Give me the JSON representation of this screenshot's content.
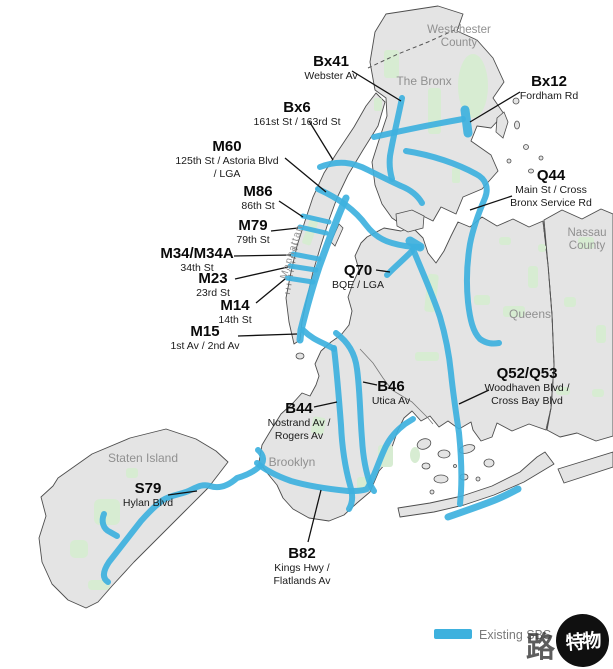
{
  "colors": {
    "route_blue": "#3EB1DE",
    "land_gray": "#e4e4e4",
    "park_green": "#d7ecd2",
    "region_label_gray": "#909090"
  },
  "regions": {
    "westchester_line1": "Westchester",
    "westchester_line2": "County",
    "bronx": "The Bronx",
    "nassau_line1": "Nassau",
    "nassau_line2": "County",
    "queens": "Queens",
    "brooklyn": "Brooklyn",
    "staten_island": "Staten Island",
    "manhattan": "Manhattan"
  },
  "routes": [
    {
      "name": "Bx41",
      "sub1": "Webster Av"
    },
    {
      "name": "Bx12",
      "sub1": "Fordham Rd"
    },
    {
      "name": "Bx6",
      "sub1": "161st St / 163rd St"
    },
    {
      "name": "M60",
      "sub1": "125th St / Astoria Blvd",
      "sub2": "/ LGA"
    },
    {
      "name": "M86",
      "sub1": "86th St"
    },
    {
      "name": "M79",
      "sub1": "79th St"
    },
    {
      "name": "M34/M34A",
      "sub1": "34th St"
    },
    {
      "name": "M23",
      "sub1": "23rd St"
    },
    {
      "name": "M14",
      "sub1": "14th St"
    },
    {
      "name": "M15",
      "sub1": "1st Av / 2nd Av"
    },
    {
      "name": "Q44",
      "sub1": "Main St / Cross",
      "sub2": "Bronx Service Rd"
    },
    {
      "name": "Q70",
      "sub1": "BQE / LGA"
    },
    {
      "name": "Q52/Q53",
      "sub1": "Woodhaven Blvd /",
      "sub2": "Cross Bay Blvd"
    },
    {
      "name": "B46",
      "sub1": "Utica Av"
    },
    {
      "name": "B44",
      "sub1": "Nostrand Av /",
      "sub2": "Rogers Av"
    },
    {
      "name": "B82",
      "sub1": "Kings Hwy /",
      "sub2": "Flatlands Av"
    },
    {
      "name": "S79",
      "sub1": "Hylan Blvd"
    }
  ],
  "legend": {
    "label": "Existing SBS"
  },
  "watermark": {
    "outside": "路",
    "inside": "特物"
  }
}
